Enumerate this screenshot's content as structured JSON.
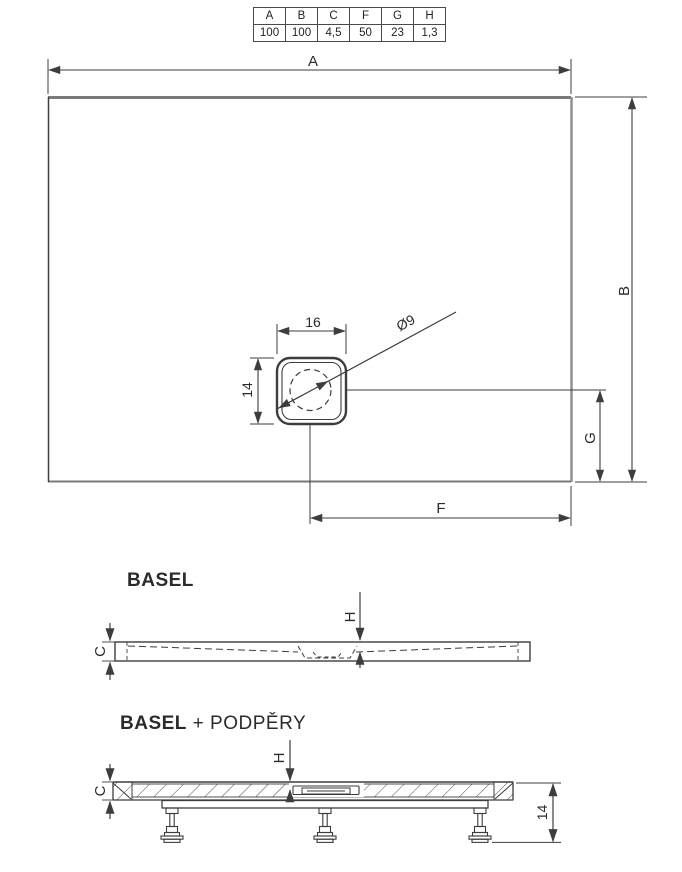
{
  "spec_table": {
    "headers": [
      "A",
      "B",
      "C",
      "F",
      "G",
      "H"
    ],
    "values": [
      "100",
      "100",
      "4,5",
      "50",
      "23",
      "1,3"
    ]
  },
  "top_view": {
    "width_label": "A",
    "depth_label": "B",
    "drain_offset_x_label": "F",
    "drain_offset_y_label": "G",
    "drain": {
      "width_label": "16",
      "height_label": "14",
      "hole_diameter_label": "Ø9"
    }
  },
  "profile_view": {
    "title": "BASEL",
    "edge_thickness_label": "C",
    "slope_depth_label": "H"
  },
  "support_view": {
    "title_model": "BASEL",
    "title_suffix": " + PODPĚRY",
    "edge_thickness_label": "C",
    "slope_depth_label": "H",
    "leg_height_label": "14"
  },
  "colors": {
    "line": "#3d3d3d",
    "thick_edge": "#7a7a7a",
    "background": "#ffffff"
  }
}
